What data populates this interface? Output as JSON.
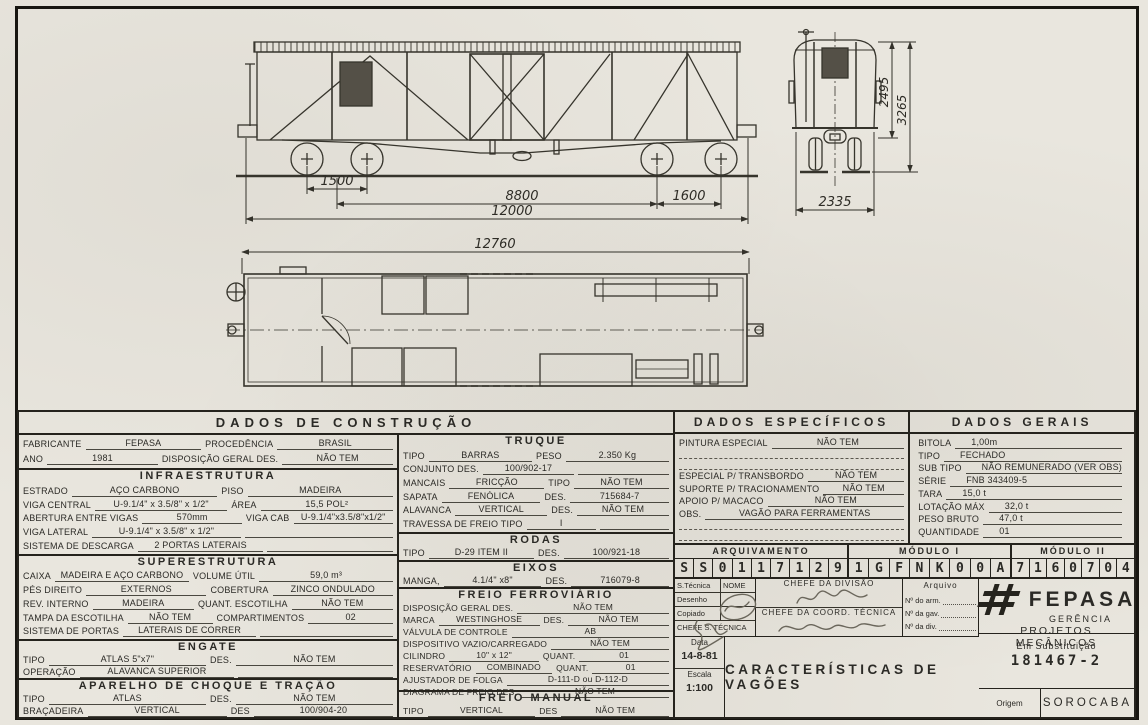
{
  "drawings": {
    "side_view": {
      "dim_truck_left": "1500",
      "dim_truck_centers": "8800",
      "dim_truck_right": "1600",
      "dim_overall": "12000"
    },
    "end_view": {
      "dim_height_body": "2495",
      "dim_height_total": "3265",
      "dim_width": "2335"
    },
    "plan_view": {
      "dim_overall": "12760"
    }
  },
  "construcao": {
    "title": "DADOS  DE  CONSTRUÇÃO",
    "geral": {
      "rows": [
        {
          "l1": "FABRICANTE",
          "v1": "FEPASA",
          "l2": "PROCEDÊNCIA",
          "v2": "BRASIL"
        },
        {
          "l1": "ANO",
          "v1": "1981",
          "l2": "DISPOSIÇÃO GERAL DES.",
          "v2": "NÃO TEM"
        }
      ]
    },
    "infraestrutura": {
      "title": "INFRAESTRUTURA",
      "rows": [
        {
          "l1": "ESTRADO",
          "v1": "AÇO CARBONO",
          "l2": "PISO",
          "v2": "MADEIRA"
        },
        {
          "l1": "VIGA CENTRAL",
          "v1": "U-9.1/4\" x 3.5/8\" x 1/2\"",
          "l2": "ÁREA",
          "v2": "15,5 POL²"
        },
        {
          "l1": "ABERTURA ENTRE VIGAS",
          "v1": "570mm",
          "l2": "VIGA CAB",
          "v2": "U-9.1/4\"x3.5/8\"x1/2\""
        },
        {
          "l1": "VIGA LATERAL",
          "v1": "U-9.1/4\" x 3.5/8\" x 1/2\"",
          "l2": "",
          "v2": ""
        },
        {
          "l1": "SISTEMA DE DESCARGA",
          "v1": "2 PORTAS LATERAIS",
          "l2": "",
          "v2": ""
        }
      ]
    },
    "superestrutura": {
      "title": "SUPERESTRUTURA",
      "rows": [
        {
          "l1": "CAIXA",
          "v1": "MADEIRA E AÇO CARBONO",
          "l2": "VOLUME ÚTIL",
          "v2": "59,0 m³"
        },
        {
          "l1": "PÉS DIREITO",
          "v1": "EXTERNOS",
          "l2": "COBERTURA",
          "v2": "ZINCO ONDULADO"
        },
        {
          "l1": "REV. INTERNO",
          "v1": "MADEIRA",
          "l2": "QUANT. ESCOTILHA",
          "v2": "NÃO TEM"
        },
        {
          "l1": "TAMPA DA ESCOTILHA",
          "v1": "NÃO TEM",
          "l2": "COMPARTIMENTOS",
          "v2": "02"
        },
        {
          "l1": "SISTEMA DE PORTAS",
          "v1": "LATERAIS DE CORRER",
          "l2": "",
          "v2": ""
        }
      ]
    },
    "engate": {
      "title": "ENGATE",
      "rows": [
        {
          "l1": "TIPO",
          "v1": "ATLAS   5\"x7\"",
          "l2": "DES.",
          "v2": "NÃO TEM"
        },
        {
          "l1": "OPERAÇÃO",
          "v1": "ALAVANCA SUPERIOR",
          "l2": "",
          "v2": ""
        }
      ]
    },
    "choque_tracao": {
      "title": "APARELHO  DE  CHOQUE  E  TRAÇÃO",
      "rows": [
        {
          "l1": "TIPO",
          "v1": "ATLAS",
          "l2": "DES.",
          "v2": "NÃO TEM"
        },
        {
          "l1": "BRAÇADEIRA",
          "v1": "VERTICAL",
          "l2": "DES",
          "v2": "100/904-20"
        }
      ]
    },
    "truque": {
      "title": "TRUQUE",
      "rows": [
        {
          "l1": "TIPO",
          "v1": "BARRAS",
          "l2": "PESO",
          "v2": "2.350 Kg"
        },
        {
          "l1": "CONJUNTO DES.",
          "v1": "100/902-17",
          "l2": "",
          "v2": ""
        },
        {
          "l1": "MANCAIS",
          "v1": "FRICÇÃO",
          "l2": "TIPO",
          "v2": "NÃO TEM"
        },
        {
          "l1": "SAPATA",
          "v1": "FENÓLICA",
          "l2": "DES.",
          "v2": "715684-7"
        },
        {
          "l1": "ALAVANCA",
          "v1": "VERTICAL",
          "l2": "DES.",
          "v2": "NÃO TEM"
        },
        {
          "l1": "TRAVESSA DE FREIO TIPO",
          "v1": "I",
          "l2": "",
          "v2": ""
        }
      ]
    },
    "rodas": {
      "title": "RODAS",
      "rows": [
        {
          "l1": "TIPO",
          "v1": "D-29  ITEM  II",
          "l2": "DES.",
          "v2": "100/921-18"
        }
      ]
    },
    "eixos": {
      "title": "EIXOS",
      "rows": [
        {
          "l1": "MANGA,",
          "v1": "4.1/4\" x8\"",
          "l2": "DES.",
          "v2": "716079-8"
        }
      ]
    },
    "freio_ferroviario": {
      "title": "FREIO  FERROVIÁRIO",
      "rows": [
        {
          "l1": "DISPOSIÇÃO GERAL DES.",
          "v1": "NÃO TEM",
          "l2": "",
          "v2": ""
        },
        {
          "l1": "MARCA",
          "v1": "WESTINGHOSE",
          "l2": "DES.",
          "v2": "NÃO TEM"
        },
        {
          "l1": "VÁLVULA DE CONTROLE",
          "v1": "AB",
          "l2": "",
          "v2": ""
        },
        {
          "l1": "DISPOSITIVO VAZIO/CARREGADO",
          "v1": "NÃO TEM",
          "l2": "",
          "v2": ""
        },
        {
          "l1": "CILINDRO",
          "v1": "10\" x 12\"",
          "l2": "QUANT.",
          "v2": "01"
        },
        {
          "l1": "RESERVATÓRIO",
          "v1": "COMBINADO",
          "l2": "QUANT.",
          "v2": "01"
        },
        {
          "l1": "AJUSTADOR DE FOLGA",
          "v1": "D-111-D  ou  D-112-D",
          "l2": "",
          "v2": ""
        },
        {
          "l1": "DIAGRAMA DE FREIO DES.",
          "v1": "NÃO TEM",
          "l2": "",
          "v2": ""
        }
      ]
    },
    "freio_manual": {
      "title": "FREIO  MANUAL",
      "rows": [
        {
          "l1": "TIPO",
          "v1": "VERTICAL",
          "l2": "DES",
          "v2": "NÃO TEM"
        }
      ]
    }
  },
  "especificos": {
    "title": "DADOS  ESPECÍFICOS",
    "rows": [
      {
        "l1": "PINTURA ESPECIAL",
        "v1": "NÃO TEM"
      },
      {
        "l1": "ESPECIAL P/ TRANSBORDO",
        "v1": "NÃO TEM"
      },
      {
        "l1": "SUPORTE P/ TRACIONAMENTO",
        "v1": "NÃO TEM"
      },
      {
        "l1": "APOIO P/ MACACO",
        "v1": "NÃO TEM"
      },
      {
        "l1": "OBS.",
        "v1": "VAGÃO  PARA  FERRAMENTAS"
      }
    ]
  },
  "gerais": {
    "title": "DADOS  GERAIS",
    "rows": [
      {
        "l1": "BITOLA",
        "v1": "1,00m"
      },
      {
        "l1": "TIPO",
        "v1": "FECHADO"
      },
      {
        "l1": "SUB TIPO",
        "v1": "NÃO REMUNERADO (VER OBS)"
      },
      {
        "l1": "SÉRIE",
        "v1": "FNB  343409-5"
      },
      {
        "l1": "TARA",
        "v1": "15,0 t"
      },
      {
        "l1": "LOTAÇÃO MÁX",
        "v1": "32,0 t"
      },
      {
        "l1": "PESO BRUTO",
        "v1": "47,0 t"
      },
      {
        "l1": "QUANTIDADE",
        "v1": "01"
      }
    ]
  },
  "arquivamento": {
    "col1_title": "ARQUIVAMENTO",
    "col2_title": "MÓDULO I",
    "col3_title": "MÓDULO II",
    "code1": [
      "S",
      "S",
      "0",
      "1",
      "1",
      "7",
      "1",
      "2",
      "9"
    ],
    "code2": [
      "1",
      "G",
      "F",
      "N",
      "K",
      "0",
      "0",
      "A"
    ],
    "code3": [
      "7",
      "1",
      "6",
      "0",
      "7",
      "0",
      "4"
    ]
  },
  "titulo_bloco": {
    "stecnica_header": "S.Técnica",
    "nome_header": "NOME",
    "linha_desenho": "Desenho",
    "linha_copiado": "Copiado",
    "linha_chefe_st": "CHEFE S. TÉCNICA",
    "chefe_divisao": "CHEFE  DA  DIVISÃO",
    "chefe_coord": "CHEFE DA COORD. TÉCNICA",
    "arquivo_title": "Arquivo",
    "arquivo_arm": "Nº do arm.",
    "arquivo_gav": "Nº da gav.",
    "arquivo_div": "Nº da div.",
    "data_label": "Data",
    "data_value": "14-8-81",
    "escala_label": "Escala",
    "escala_value": "1:100",
    "titulo": "CARACTERÍSTICAS  DE  VAGÕES",
    "fepasa_nome": "FEPASA",
    "fepasa_sub1": "GERÊNCIA",
    "fepasa_sub2": "PROJETOS  MECÂNICOS",
    "subst_label": "Em  Substituição",
    "subst_value": "181467-2",
    "origem_label": "Origem",
    "origem_value": "SOROCABA"
  }
}
